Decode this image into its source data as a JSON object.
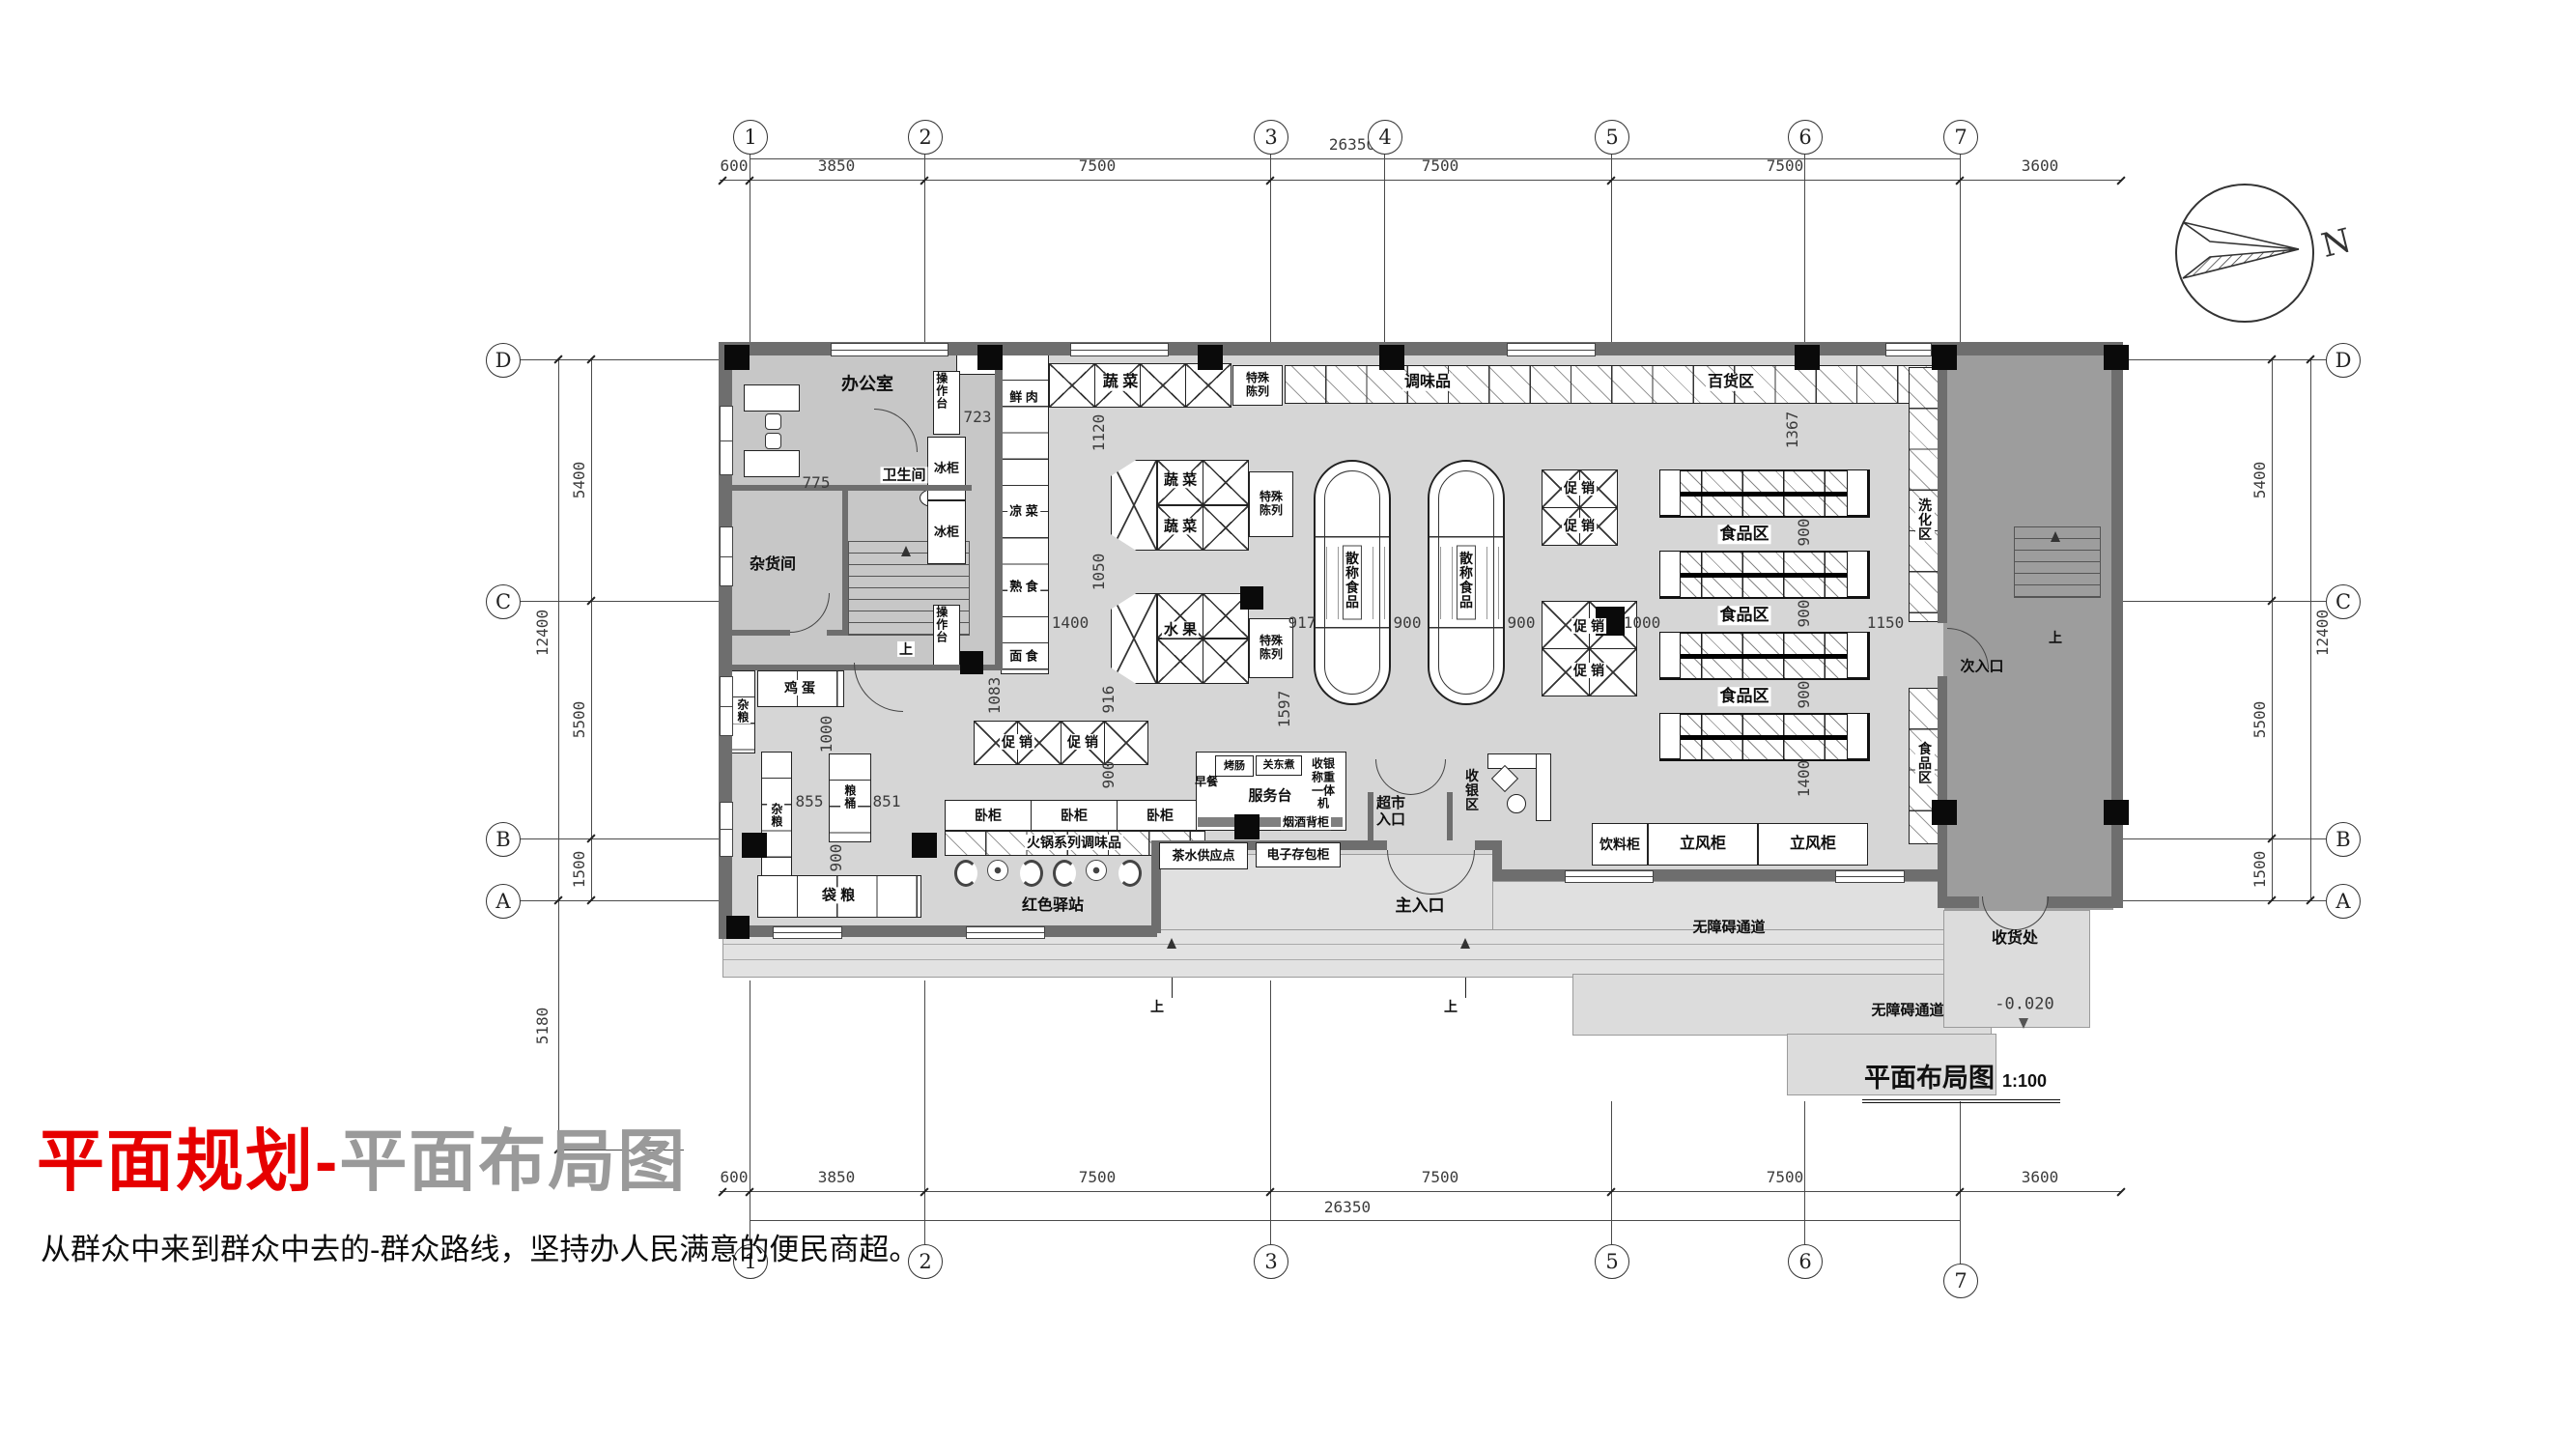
{
  "page": {
    "title_red": "平面规划",
    "title_dash": "-",
    "title_gray": "平面布局图",
    "subtitle": "从群众中来到群众中去的-群众路线，坚持办人民满意的便民商超。"
  },
  "drawing": {
    "name": "平面布局图",
    "scale": "1:100",
    "north": "N",
    "elevation": "-0.020"
  },
  "grid": {
    "cols": [
      "1",
      "2",
      "3",
      "4",
      "5",
      "6",
      "7"
    ],
    "cols_bottom": [
      "1",
      "2",
      "3",
      "5",
      "6",
      "7"
    ],
    "rows": [
      "D",
      "C",
      "B",
      "A"
    ]
  },
  "dims": {
    "top": [
      "600",
      "3850",
      "7500",
      "7500",
      "7500",
      "3600"
    ],
    "bottom": [
      "600",
      "3850",
      "7500",
      "7500",
      "7500",
      "3600"
    ],
    "total": "26350",
    "left": {
      "dc": "5400",
      "cb": "5500",
      "ba": "1500",
      "total": "12400",
      "south": "5180"
    },
    "right": {
      "dc": "5400",
      "cb": "5500",
      "ba": "1500",
      "total": "12400"
    }
  },
  "rooms": {
    "office": "办公室",
    "toilet": "卫生间",
    "storage": "杂货间",
    "receiving": "收货处",
    "cashier_zone": "收银区",
    "wash_zone": "洗化区",
    "food_zone": "食品区",
    "dept_zone": "百货区"
  },
  "labels": {
    "op_table": "操作台",
    "freezer": "冰柜",
    "fresh_meat": "鲜 肉",
    "cold_dish": "凉 菜",
    "cooked_food": "熟 食",
    "noodle": "面 食",
    "veg": "蔬 菜",
    "fruit": "水 果",
    "special": "特殊陈列",
    "seasoning": "调味品",
    "bulk_food": "散称食品",
    "promo": "促 销",
    "grain": "杂粮",
    "egg": "鸡 蛋",
    "grain_barrel": "粮桶",
    "bag_grain": "袋 粮",
    "chest": "卧柜",
    "hotpot": "火锅系列调味品",
    "red_station": "红色驿站",
    "tea_point": "茶水供应点",
    "locker": "电子存包柜",
    "tobacco": "烟酒背柜",
    "service": "服务台",
    "breakfast": "早餐",
    "sausage": "烤肠",
    "oden": "关东煮",
    "pos": "收银称重一体机",
    "market_entry": "超市入口",
    "main_entry": "主入口",
    "sub_entry": "次入口",
    "drink": "饮料柜",
    "upright": "立风柜",
    "barrier_free": "无障碍通道",
    "up": "上"
  },
  "plan_dims": {
    "v723": "723",
    "v775": "775",
    "v1120": "1120",
    "v1050": "1050",
    "v1400a": "1400",
    "v1083": "1083",
    "v916": "916",
    "v1000a": "1000",
    "v855": "855",
    "v851": "851",
    "v900a": "900",
    "v900b": "900",
    "v917": "917",
    "v900c": "900",
    "v900d": "900",
    "v1000b": "1000",
    "v1150": "1150",
    "v1367": "1367",
    "v900e": "900",
    "v900f": "900",
    "v900g": "900",
    "v1400b": "1400",
    "v1597": "1597"
  }
}
